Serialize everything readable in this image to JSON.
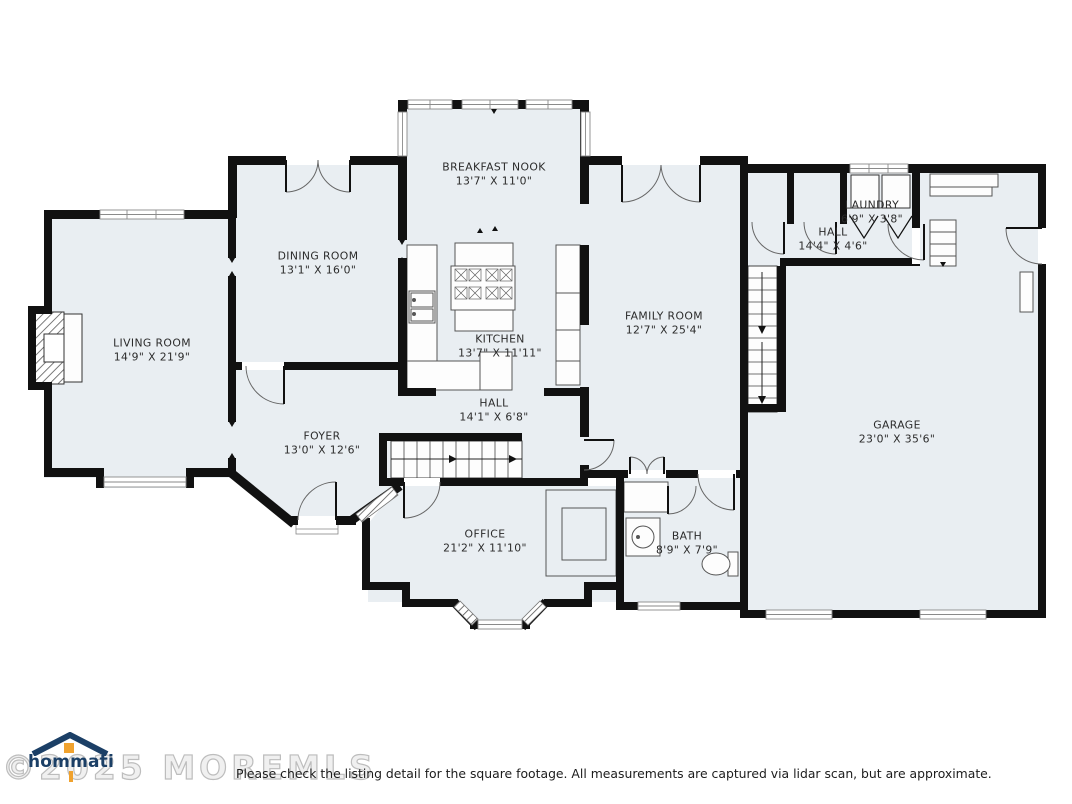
{
  "plan": {
    "floor_color": "#e9eef2",
    "wall_color": "#111111",
    "rooms": {
      "breakfast_nook": {
        "name": "BREAKFAST NOOK",
        "dims": "13'7\" X 11'0\""
      },
      "dining_room": {
        "name": "DINING ROOM",
        "dims": "13'1\" X 16'0\""
      },
      "living_room": {
        "name": "LIVING ROOM",
        "dims": "14'9\" X 21'9\""
      },
      "kitchen": {
        "name": "KITCHEN",
        "dims": "13'7\" X 11'11\""
      },
      "family_room": {
        "name": "FAMILY ROOM",
        "dims": "12'7\" X 25'4\""
      },
      "laundry": {
        "name": "LAUNDRY",
        "dims": "6'9\" X 3'8\""
      },
      "hall_upper": {
        "name": "HALL",
        "dims": "14'4\" X 4'6\""
      },
      "hall_lower": {
        "name": "HALL",
        "dims": "14'1\" X 6'8\""
      },
      "foyer": {
        "name": "FOYER",
        "dims": "13'0\" X 12'6\""
      },
      "office": {
        "name": "OFFICE",
        "dims": "21'2\" X 11'10\""
      },
      "bath": {
        "name": "BATH",
        "dims": "8'9\" X 7'9\""
      },
      "garage": {
        "name": "GARAGE",
        "dims": "23'0\" X 35'6\""
      }
    }
  },
  "footer": {
    "logo_text": "hommati",
    "watermark": "©2025 MOREMLS",
    "disclaimer": "Please check the listing detail for the square footage. All measurements are captured via lidar scan, but are approximate."
  },
  "colors": {
    "logo_navy": "#1b3f66",
    "logo_orange": "#f0a22e",
    "watermark_gray": "#bdbdbd"
  }
}
